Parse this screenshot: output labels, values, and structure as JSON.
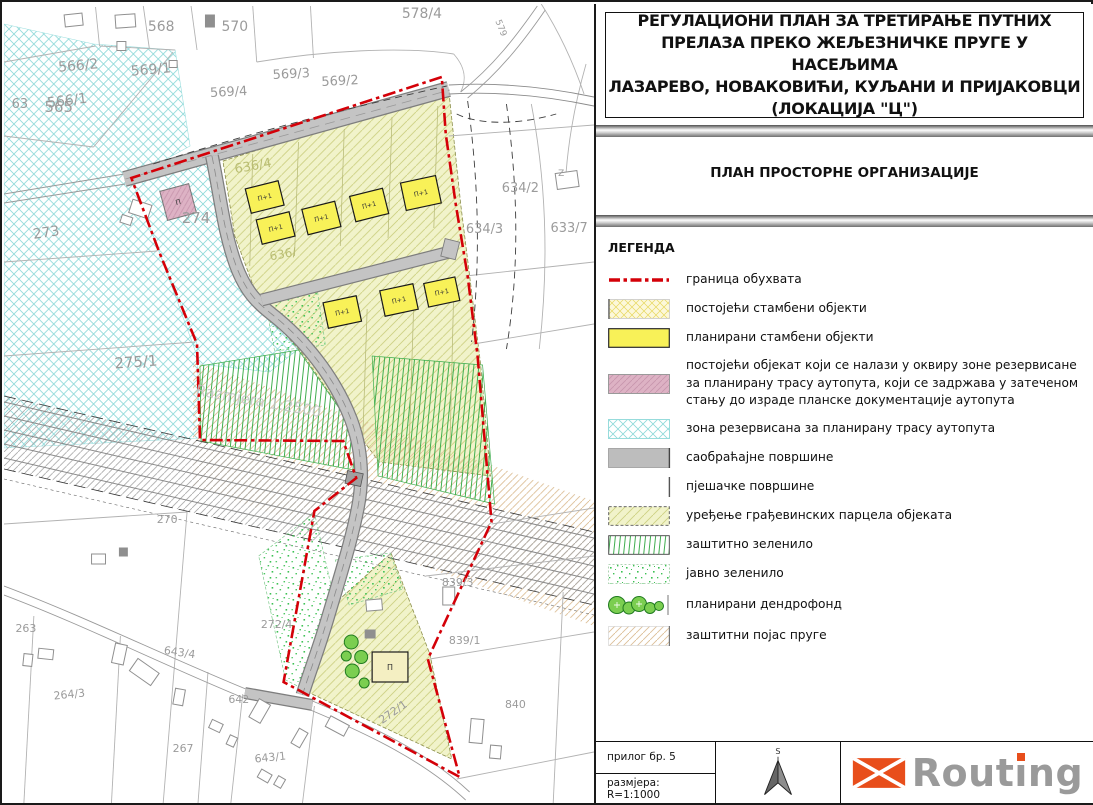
{
  "panel": {
    "title_lines": [
      "РЕГУЛАЦИОНИ ПЛАН ЗА ТРЕТИРАЊЕ ПУТНИХ",
      "ПРЕЛАЗА ПРЕКО ЖЕЉЕЗНИЧКЕ ПРУГЕ У НАСЕЉИМА",
      "ЛАЗАРЕВО, НОВАКОВИЋИ, КУЉАНИ И ПРИЈАКОВЦИ",
      "(ЛОКАЦИЈА \"Ц\")"
    ],
    "subtitle": "ПЛАН ПРОСТОРНЕ ОРГАНИЗАЦИЈЕ",
    "legend_header": "ЛЕГЕНДА",
    "legend_items": [
      {
        "key": "boundary",
        "label": "граница обухвата"
      },
      {
        "key": "existing-residential",
        "label": "постојећи стамбени објекти"
      },
      {
        "key": "planned-residential",
        "label": "планирани стамбени објекти"
      },
      {
        "key": "existing-object-in-reserved-zone",
        "label": "постојећи објекат који се налази у оквиру зоне резервисане за планирану трасу аутопута, који се задржава у затеченом стању до израде планске документације аутопута"
      },
      {
        "key": "reserved-zone",
        "label": "зона резервисана за планирану трасу аутопута"
      },
      {
        "key": "traffic-surfaces",
        "label": "саобраћајне површине"
      },
      {
        "key": "pedestrian-surfaces",
        "label": "пјешачке површине"
      },
      {
        "key": "parcel-arrangement",
        "label": "уређење грађевинских парцела објеката"
      },
      {
        "key": "protective-greenery",
        "label": "заштитно зеленило"
      },
      {
        "key": "public-greenery",
        "label": "јавно зеленило"
      },
      {
        "key": "planned-dendrofund",
        "label": "планирани дендрофонд"
      },
      {
        "key": "railway-protection-belt",
        "label": "заштитни појас пруге"
      }
    ],
    "footer": {
      "attachment_label": "прилог бр. 5",
      "scale_label": "размјера:  R=1:1000",
      "north_label": "S",
      "logo_text": "Routing"
    }
  },
  "map": {
    "watermark": "Razmjera 1:2500",
    "building_label_planned": "П+1",
    "building_label_existing": "П",
    "parcel_labels": [
      {
        "t": "565",
        "x": 55,
        "y": 108,
        "s": 15
      },
      {
        "t": "566/2",
        "x": 75,
        "y": 66,
        "s": 14,
        "r": -5
      },
      {
        "t": "569/1",
        "x": 148,
        "y": 70,
        "s": 14,
        "r": -5
      },
      {
        "t": "568",
        "x": 158,
        "y": 27,
        "s": 14
      },
      {
        "t": "570",
        "x": 232,
        "y": 27,
        "s": 14
      },
      {
        "t": "578/4",
        "x": 420,
        "y": 14,
        "s": 14
      },
      {
        "t": "569/3",
        "x": 289,
        "y": 74,
        "s": 13,
        "r": -3
      },
      {
        "t": "569/2",
        "x": 338,
        "y": 81,
        "s": 13,
        "r": -3
      },
      {
        "t": "569/4",
        "x": 226,
        "y": 92,
        "s": 13,
        "r": -3
      },
      {
        "t": "566/1",
        "x": 64,
        "y": 101,
        "s": 14,
        "r": -7
      },
      {
        "t": "63",
        "x": 16,
        "y": 104,
        "s": 13
      },
      {
        "t": "273",
        "x": 43,
        "y": 233,
        "s": 14,
        "r": -8
      },
      {
        "t": "274",
        "x": 193,
        "y": 219,
        "s": 15
      },
      {
        "t": "275/1",
        "x": 133,
        "y": 363,
        "s": 15,
        "r": -4
      },
      {
        "t": "270",
        "x": 164,
        "y": 519,
        "s": 11
      },
      {
        "t": "634/2",
        "x": 519,
        "y": 188,
        "s": 13
      },
      {
        "t": "634/3",
        "x": 483,
        "y": 229,
        "s": 13
      },
      {
        "t": "633/7",
        "x": 568,
        "y": 228,
        "s": 13
      },
      {
        "t": "636/4",
        "x": 251,
        "y": 166,
        "s": 13,
        "r": -10,
        "c": "#b9bd72"
      },
      {
        "t": "636/",
        "x": 281,
        "y": 254,
        "s": 12,
        "r": -10,
        "c": "#b9bd72"
      },
      {
        "t": "263",
        "x": 22,
        "y": 628,
        "s": 11
      },
      {
        "t": "264/3",
        "x": 66,
        "y": 694,
        "s": 11,
        "r": -6
      },
      {
        "t": "643/4",
        "x": 176,
        "y": 652,
        "s": 11,
        "r": 8
      },
      {
        "t": "267",
        "x": 180,
        "y": 748,
        "s": 11
      },
      {
        "t": "642",
        "x": 236,
        "y": 699,
        "s": 11
      },
      {
        "t": "643/1",
        "x": 268,
        "y": 757,
        "s": 11,
        "r": -6
      },
      {
        "t": "272/4",
        "x": 274,
        "y": 624,
        "s": 11
      },
      {
        "t": "272/1",
        "x": 393,
        "y": 711,
        "s": 11,
        "r": -35
      },
      {
        "t": "839/3",
        "x": 456,
        "y": 582,
        "s": 11
      },
      {
        "t": "839/1",
        "x": 463,
        "y": 640,
        "s": 11
      },
      {
        "t": "840",
        "x": 514,
        "y": 704,
        "s": 11
      },
      {
        "t": "579",
        "x": 497,
        "y": 25,
        "s": 9,
        "r": 68
      },
      {
        "t": "Z",
        "x": 560,
        "y": 172,
        "s": 9
      }
    ],
    "planned_buildings": [
      [
        262,
        193,
        34,
        25,
        -14
      ],
      [
        273,
        224,
        34,
        25,
        -14
      ],
      [
        319,
        214,
        34,
        26,
        -14
      ],
      [
        367,
        201,
        34,
        26,
        -14
      ],
      [
        419,
        189,
        36,
        28,
        -12
      ],
      [
        340,
        308,
        34,
        26,
        -12
      ],
      [
        397,
        296,
        34,
        26,
        -12
      ],
      [
        440,
        288,
        32,
        24,
        -12
      ]
    ],
    "pink_building": [
      175,
      198,
      30,
      30,
      -15
    ],
    "bottom_building": [
      388,
      663,
      36,
      30,
      0
    ],
    "trees": [
      [
        349,
        638,
        7
      ],
      [
        359,
        653,
        6.5
      ],
      [
        350,
        667,
        7
      ],
      [
        362,
        679,
        5
      ],
      [
        344,
        652,
        5
      ]
    ],
    "houses": [
      [
        70,
        16,
        18,
        12,
        -6
      ],
      [
        122,
        17,
        20,
        13,
        -4
      ],
      [
        207,
        17,
        9,
        12,
        0,
        1
      ],
      [
        118,
        42,
        9,
        9,
        0
      ],
      [
        170,
        60,
        8,
        7,
        0
      ],
      [
        137,
        205,
        20,
        14,
        18
      ],
      [
        123,
        216,
        11,
        8,
        18
      ],
      [
        42,
        650,
        15,
        10,
        6
      ],
      [
        24,
        656,
        9,
        12,
        6
      ],
      [
        116,
        650,
        12,
        20,
        12
      ],
      [
        141,
        668,
        26,
        15,
        35
      ],
      [
        176,
        693,
        10,
        16,
        10
      ],
      [
        213,
        722,
        12,
        9,
        25
      ],
      [
        229,
        737,
        8,
        10,
        25
      ],
      [
        257,
        707,
        13,
        21,
        30
      ],
      [
        297,
        734,
        10,
        17,
        30
      ],
      [
        335,
        722,
        21,
        12,
        28
      ],
      [
        262,
        772,
        12,
        9,
        30
      ],
      [
        277,
        778,
        8,
        10,
        30
      ],
      [
        475,
        727,
        13,
        24,
        5
      ],
      [
        494,
        748,
        11,
        13,
        5
      ],
      [
        372,
        601,
        16,
        11,
        -5
      ],
      [
        447,
        592,
        12,
        18,
        0
      ],
      [
        368,
        630,
        10,
        8,
        0,
        1
      ],
      [
        566,
        176,
        22,
        16,
        -8
      ],
      [
        95,
        555,
        14,
        10,
        0
      ],
      [
        120,
        548,
        8,
        8,
        0,
        1
      ]
    ]
  },
  "colors": {
    "boundary_red": "#d40008",
    "planned_yellow": "#f8f158",
    "reserved_cyan": "#8ed9d9",
    "traffic_gray": "#bdbdbd",
    "greenery_green": "#3fae4e",
    "railway_tan": "#dcbf97",
    "existing_pink": "#ddb2c4",
    "parcel_olive": "#f1f3ca",
    "logo_orange": "#e84e1b",
    "logo_gray": "#9a9a9a"
  }
}
